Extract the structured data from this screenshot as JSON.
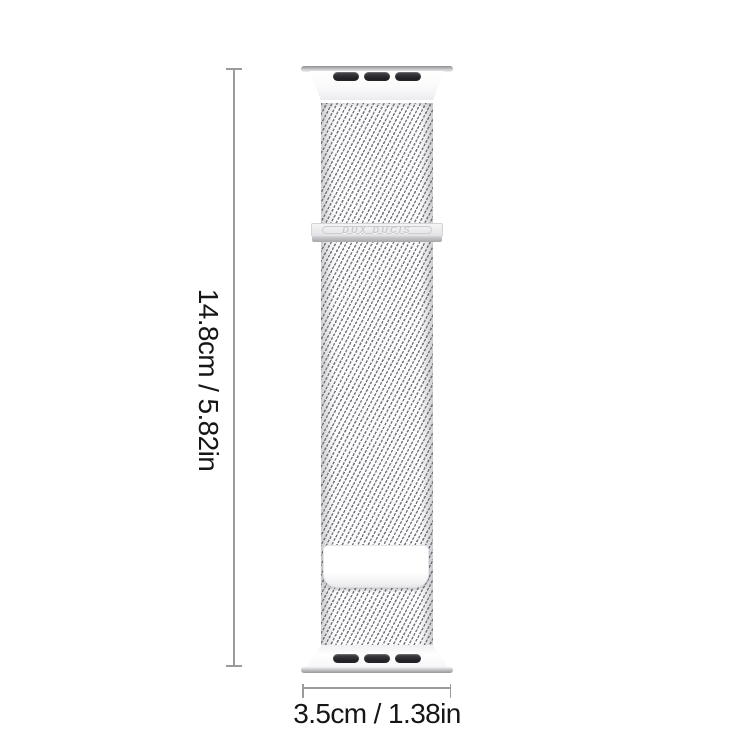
{
  "product": {
    "brand_label": "DUX DUCIS",
    "band_style": "milanese-loop-mesh",
    "slot_count_per_connector": 3,
    "colors": {
      "band_silver": "#e9e9eb",
      "mesh_stroke": "#73737b",
      "connector_slot_dark": "#2b2b2f",
      "magnet_plate_white": "#ffffff"
    }
  },
  "dimensions": {
    "height_label": "14.8cm / 5.82in",
    "width_label": "3.5cm / 1.38in",
    "line_color": "#9b9b9b",
    "text_color": "#161616"
  }
}
